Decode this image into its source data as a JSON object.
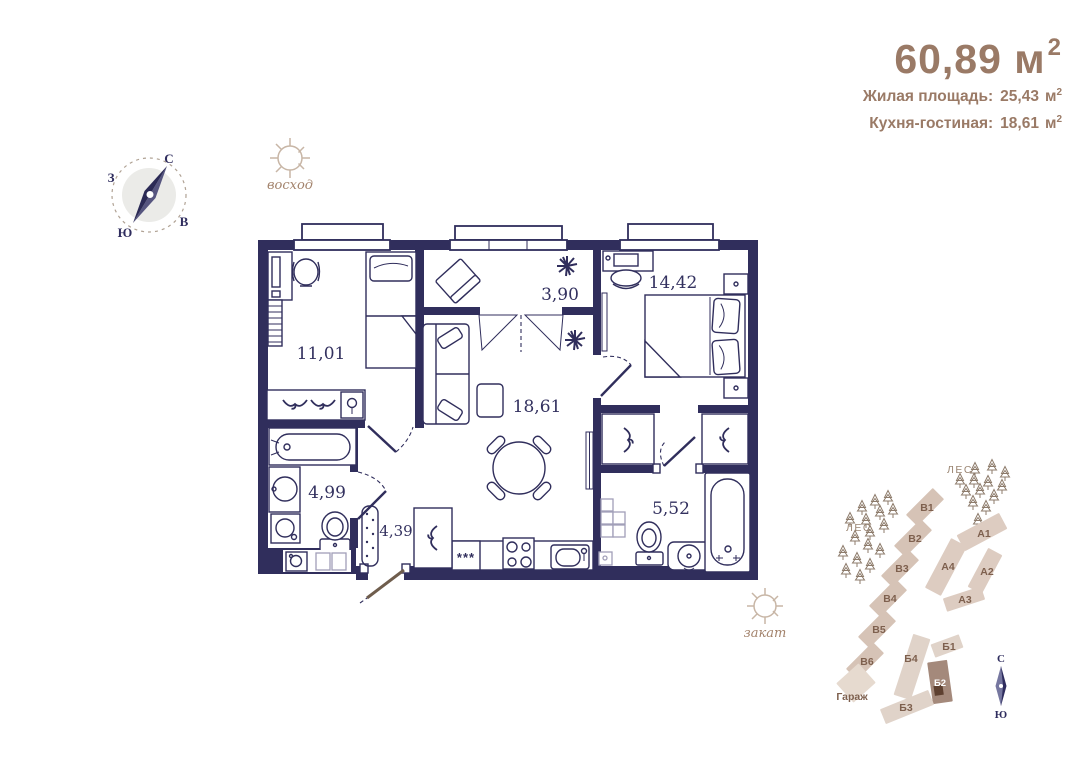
{
  "header": {
    "total_area": "60,89 м",
    "total_area_sup": "2",
    "stats": [
      {
        "label": "Жилая площадь:",
        "value": "25,43",
        "unit": "м",
        "sup": "2"
      },
      {
        "label": "Кухня-гостиная:",
        "value": "18,61",
        "unit": "м",
        "sup": "2"
      }
    ]
  },
  "compass": {
    "n": "С",
    "e": "В",
    "s": "Ю",
    "w": "З"
  },
  "suns": {
    "sunrise": "восход",
    "sunset": "закат"
  },
  "floor_plan": {
    "rooms": [
      {
        "id": "bedroom-1",
        "area": "11,01"
      },
      {
        "id": "loggia",
        "area": "3,90"
      },
      {
        "id": "bedroom-2",
        "area": "14,42"
      },
      {
        "id": "kitchen-living",
        "area": "18,61"
      },
      {
        "id": "bathroom",
        "area": "4,99"
      },
      {
        "id": "hallway",
        "area": "4,39"
      },
      {
        "id": "ensuite-bathroom",
        "area": "5,52"
      }
    ],
    "fridge_symbol": "***"
  },
  "site_plan": {
    "forest_1": "ЛЕС",
    "forest_2": "ЛЕС",
    "garage": "Гараж",
    "buildings": [
      {
        "label": "В1"
      },
      {
        "label": "В2"
      },
      {
        "label": "В3"
      },
      {
        "label": "В4"
      },
      {
        "label": "В5"
      },
      {
        "label": "В6"
      },
      {
        "label": "А1"
      },
      {
        "label": "А2"
      },
      {
        "label": "А3"
      },
      {
        "label": "А4"
      },
      {
        "label": "Б1"
      },
      {
        "label": "Б2",
        "highlighted": true
      },
      {
        "label": "Б3"
      },
      {
        "label": "Б4"
      }
    ],
    "compass": {
      "n": "С",
      "s": "Ю"
    }
  },
  "colors": {
    "wall": "#302e5c",
    "accent_brown": "#9a7a66",
    "site_beige": "#d6c3b6",
    "site_beige_light": "#ddccc1",
    "site_highlight": "#a4897b",
    "label_brown": "#7e604e"
  }
}
